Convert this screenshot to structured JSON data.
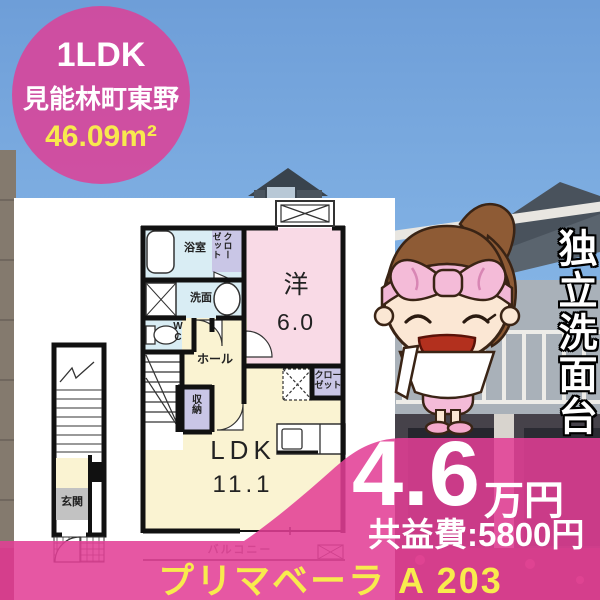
{
  "badge": {
    "layout_type": "1LDK",
    "location": "見能林町東野",
    "area": "46.09m²"
  },
  "floorplan": {
    "bath": "浴室",
    "closet_top_col_right": "クロー",
    "closet_top_col_left": "ゼット",
    "washroom": "洗面",
    "wc": "WC",
    "hall": "ホール",
    "storage": "収納",
    "western_room": "洋",
    "western_size": "6.0",
    "closet2_line1": "クロー",
    "closet2_line2": "ゼット",
    "ldk": "LDK",
    "ldk_size": "11.1",
    "balcony": "バルコニー",
    "entrance": "玄関"
  },
  "feature_vertical": "独立洗面台",
  "price": {
    "amount": "4.6",
    "unit": "万円",
    "common_fee": "共益費:5800円"
  },
  "property_name": "プリマベーラ A 203",
  "colors": {
    "brand_pink": "#E23E95",
    "accent_yellow": "#F8EB4D",
    "room_pink": "#F9DAE6",
    "room_yellow": "#FAF3D2",
    "room_blue": "#D9EDF4",
    "room_purple": "#C9C6E6"
  }
}
